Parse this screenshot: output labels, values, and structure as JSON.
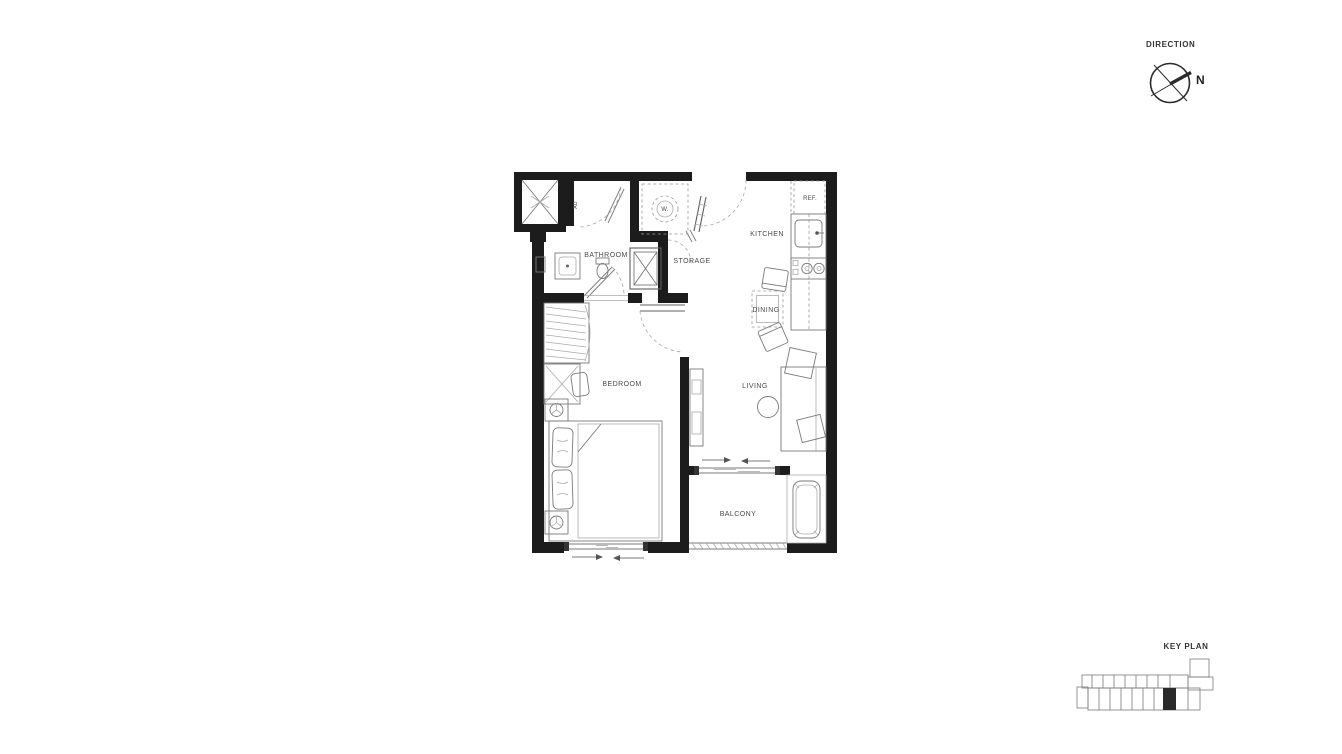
{
  "direction": {
    "label": "DIRECTION",
    "north": "N"
  },
  "key_plan": {
    "label": "KEY PLAN"
  },
  "floor_plan": {
    "rooms": {
      "bathroom": "BATHROOM",
      "storage": "STORAGE",
      "kitchen": "KITCHEN",
      "dining": "DINING",
      "bedroom": "BEDROOM",
      "living": "LIVING",
      "balcony": "BALCONY"
    },
    "fixtures": {
      "washer": "W.",
      "refrigerator": "REF.",
      "air_duct": "AD"
    },
    "colors": {
      "wall": "#1c1c1c",
      "thin_line": "#7a7a7a",
      "dashed_line": "#9a9a9a",
      "label_text": "#4a4a4a",
      "background": "#ffffff",
      "keyplan_highlight": "#2a2a2a"
    }
  }
}
